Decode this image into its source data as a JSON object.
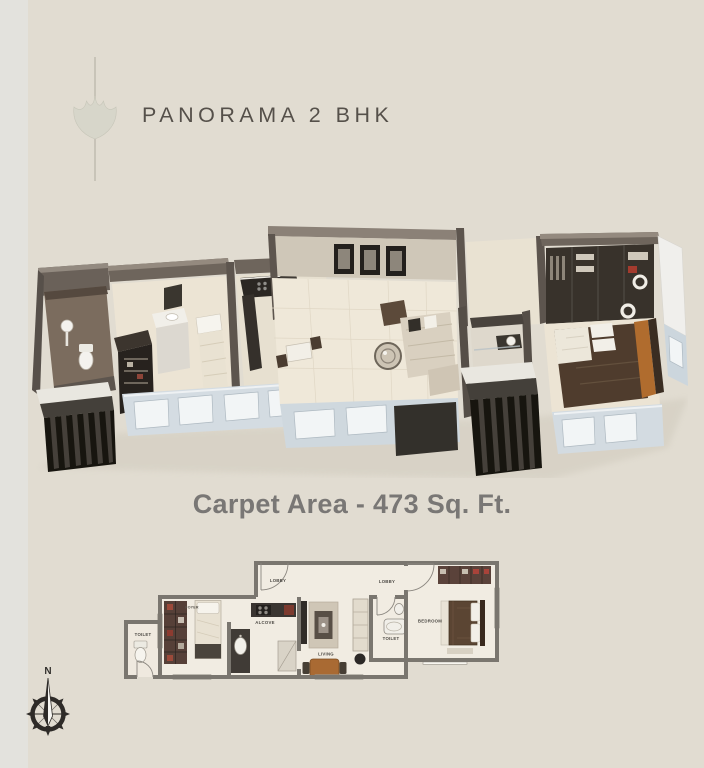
{
  "page": {
    "background": "#e1dcd1"
  },
  "header": {
    "title": "PANORAMA 2 BHK",
    "logo": "fan-leaf-motif"
  },
  "carpet": {
    "label": "Carpet Area - 473 Sq. Ft."
  },
  "plan2d": {
    "labels": {
      "toilet_left": "TOILET",
      "foyer": "FOYER",
      "alcove": "ALCOVE",
      "lobby_left": "LOBBY",
      "lobby_right": "LOBBY",
      "living": "LIVING",
      "toilet_mid": "TOILET",
      "bedroom": "BEDROOM"
    }
  },
  "compass": {
    "north": "N"
  },
  "colors": {
    "background": "#e1dcd1",
    "title_text": "#55504a",
    "body_text": "#797775",
    "plan_wall": "#7a766f",
    "accent_wood": "#a96a33",
    "render_wall": "#6e655c"
  }
}
